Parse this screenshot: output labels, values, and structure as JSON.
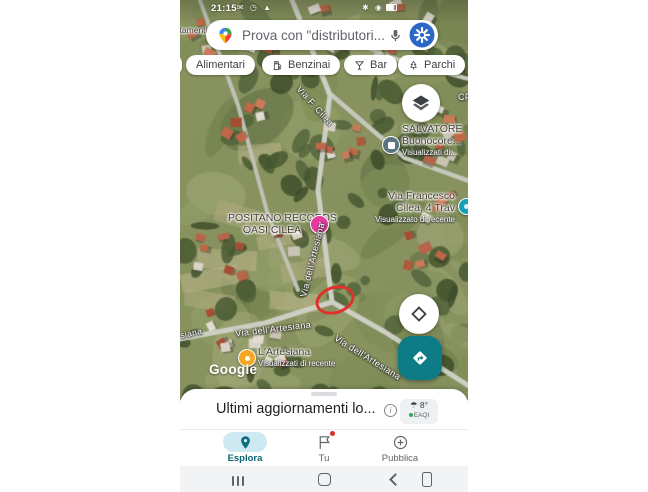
{
  "status_bar": {
    "time": "21:15",
    "left_icons": "✉ ◷ ▲",
    "right_icons": "✱ ◉"
  },
  "search": {
    "placeholder": "Prova con \"distributori..."
  },
  "chips": {
    "alimentari": "Alimentari",
    "benzinai": "Benzinai",
    "bar": "Bar",
    "parchi": "Parchi"
  },
  "map": {
    "fragment_top_left": "artamenti",
    "fragment_right_edge": "CP",
    "street_via_f_cilea": "Via F. Cilea",
    "street_artesiana_vertical": "Via dell'Artesiana",
    "street_artesiana_left_fragment": "siana",
    "street_artesiana_horizontal": "Via dell'Artesiana",
    "street_artesiana_diagonal": "Via dell'Artesiana",
    "poi_salvatore": {
      "line1": "SALVATORE",
      "line2": "Buonocore...",
      "sub": "Visualizzati di..."
    },
    "poi_francesco": {
      "line1": "Via Francesco",
      "line2": "Cilea, 4 Trav",
      "sub": "Visualizzato di recente"
    },
    "poi_positano": {
      "line1": "POSITANO RECORDS",
      "line2": "OASI CILEA",
      "marker_glyph": "♪"
    },
    "poi_artesiana": {
      "line1": "L'Artesiana",
      "sub": "Visualizzati di recente"
    },
    "watermark": "Google"
  },
  "bottom_sheet": {
    "title": "Ultimi aggiornamenti lo...",
    "weather_temp": "8°",
    "air_quality": "EAQI"
  },
  "bottom_nav": {
    "esplora": "Esplora",
    "tu": "Tu",
    "pubblica": "Pubblica"
  },
  "colors": {
    "accent_teal": "#0e7c86",
    "esplora_pill": "#cdeaf2",
    "red_annotation": "#e0312c",
    "avatar_blue": "#2b66c9"
  }
}
